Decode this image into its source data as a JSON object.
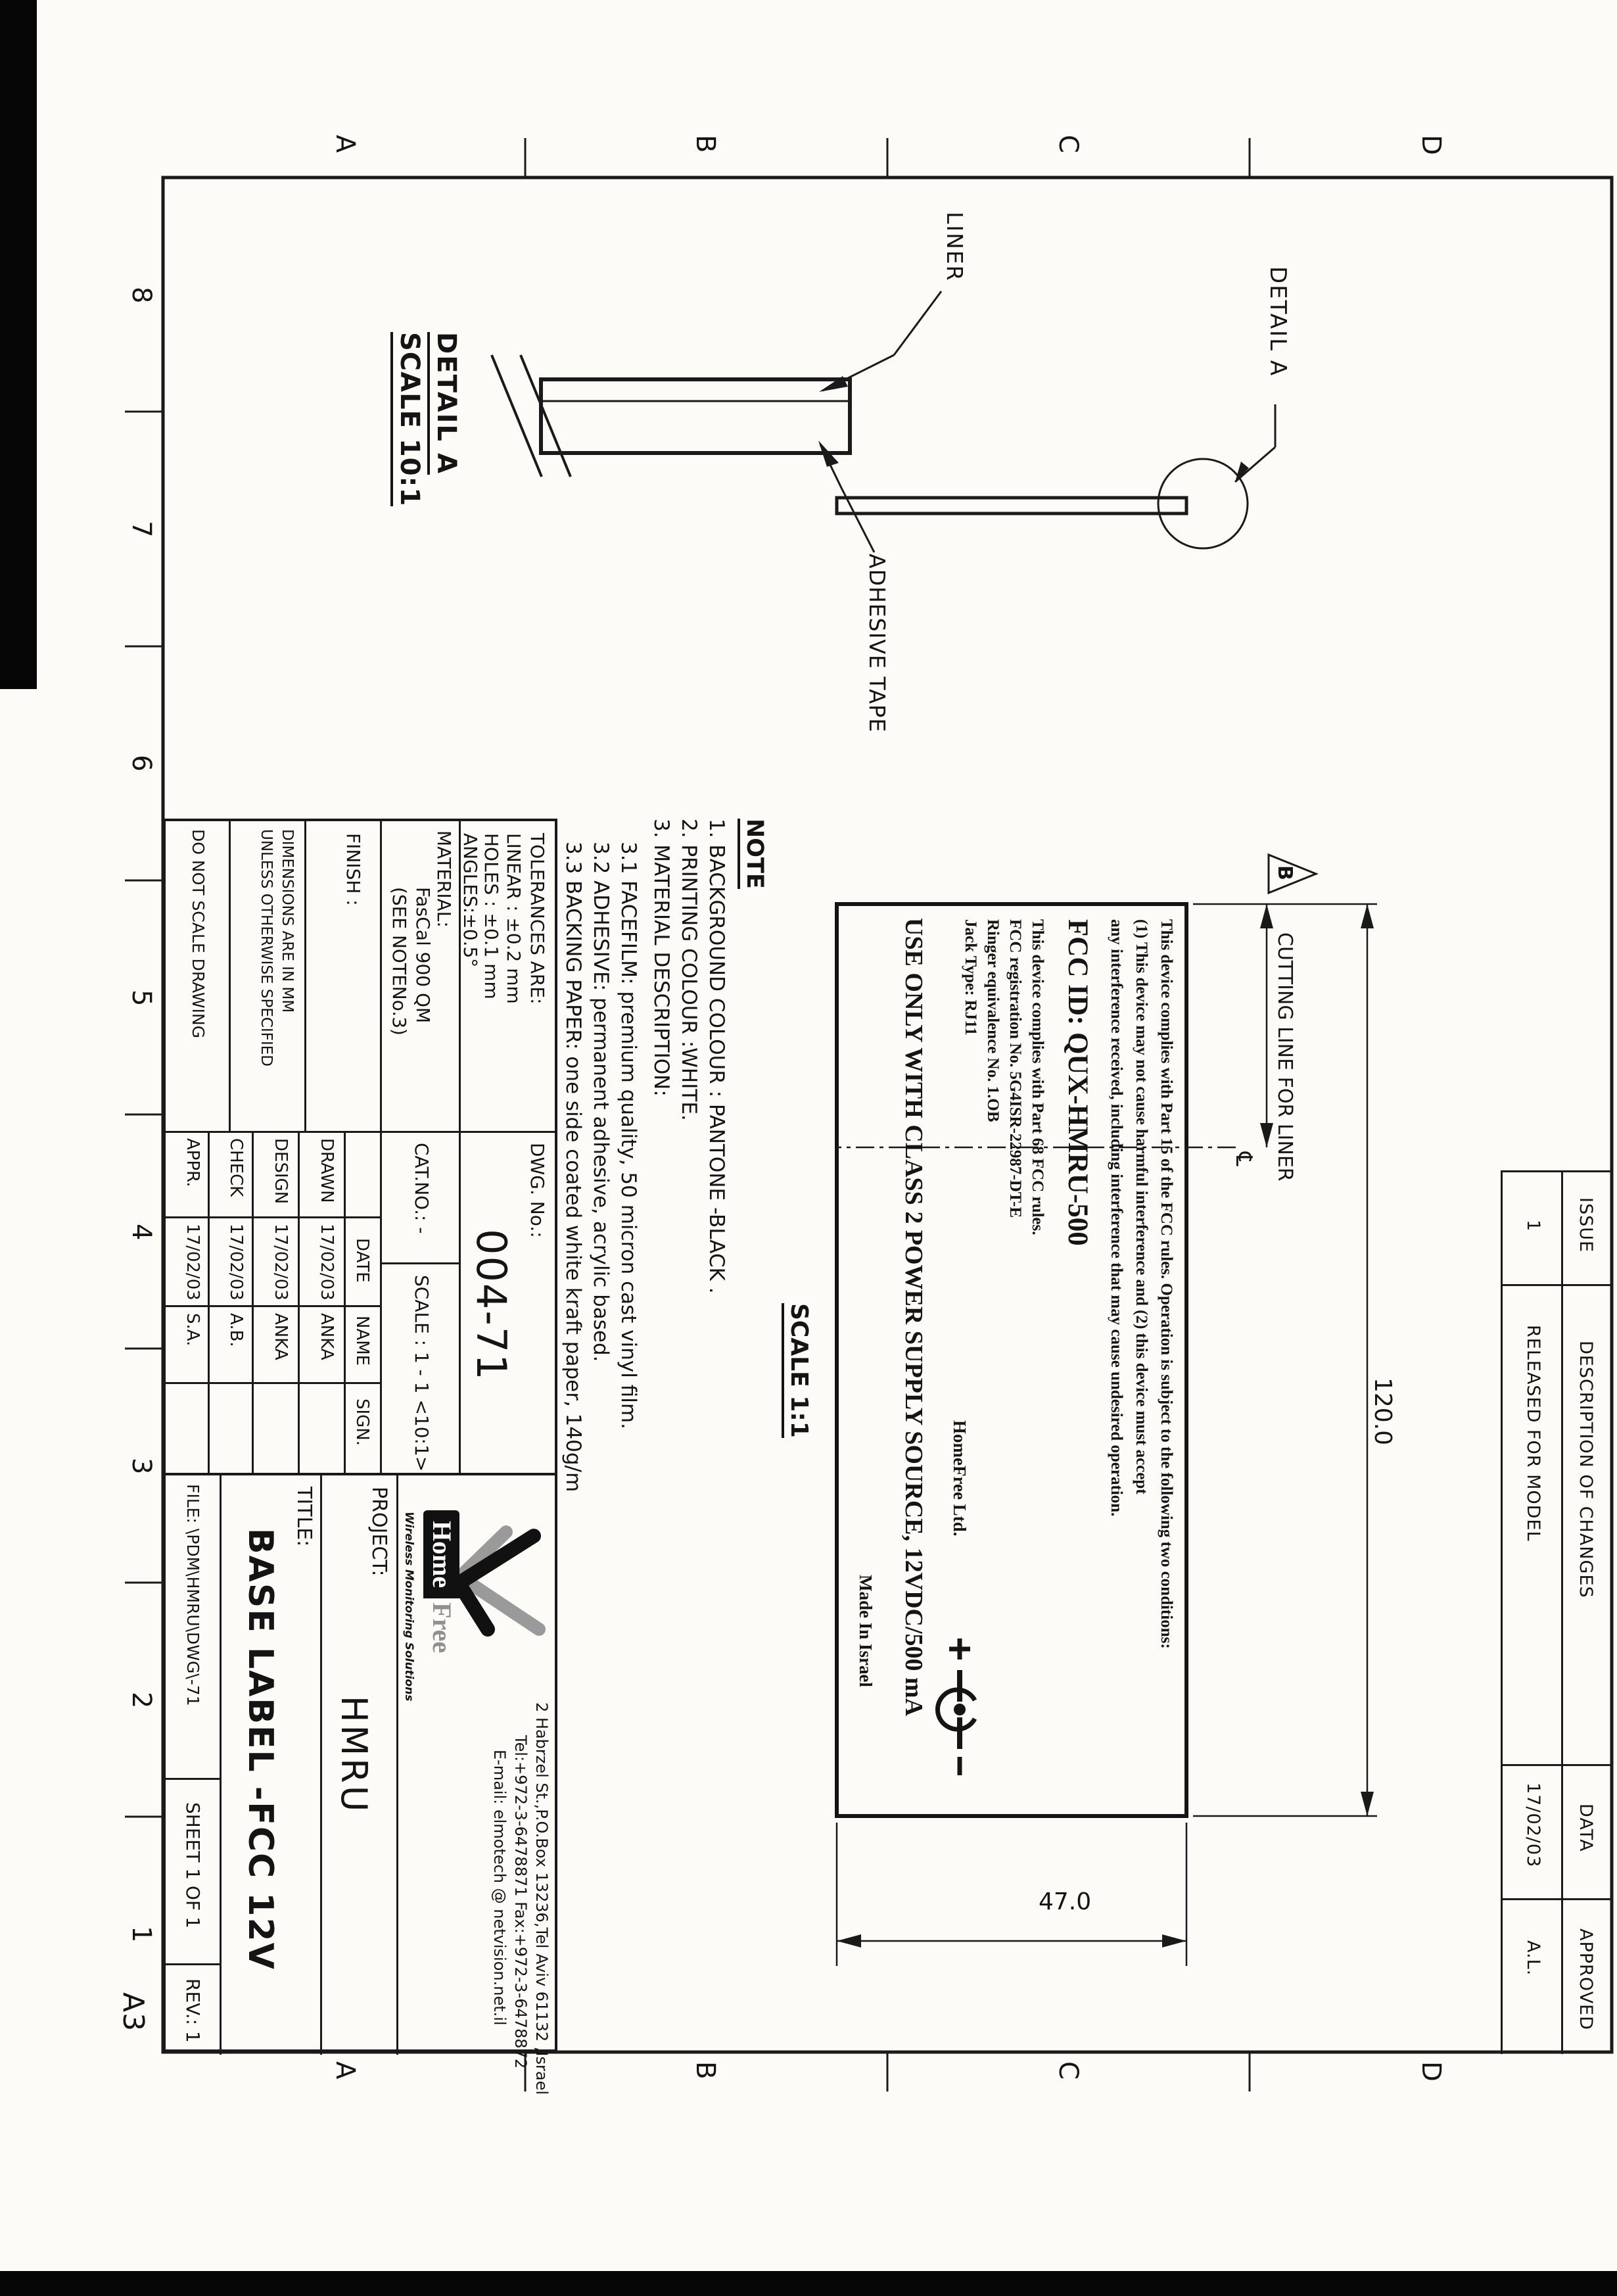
{
  "sheet": {
    "format": "A3",
    "zone_letters": [
      "D",
      "C",
      "B",
      "A"
    ],
    "zone_numbers": [
      "8",
      "7",
      "6",
      "5",
      "4",
      "3",
      "2",
      "1"
    ]
  },
  "revision_table": {
    "headers": {
      "issue": "ISSUE",
      "description": "DESCRIPTION OF CHANGES",
      "date": "DATA",
      "approved": "APPROVED"
    },
    "row": {
      "issue": "1",
      "description": "RELEASED FOR MODEL",
      "date": "17/02/03",
      "approved": "A.L."
    }
  },
  "views": {
    "detail_callout": "DETAIL A",
    "label_face": {
      "p15_lines": [
        "This device complies with Part 15 of the FCC rules. Operation is subject to the following two conditions:",
        "(1) This device may not cause harmful interference and (2) this device must accept",
        "any interference received, including interference that may cause undesired operation."
      ],
      "fcc_id": "FCC ID: QUX-HMRU-500",
      "p68_lines": [
        "This device complies with Part 68 FCC rules.",
        "FCC registration No. 5G4ISR-22987-DT-E",
        "Ringer equivalence No. 1.OB",
        "Jack Type: RJ11"
      ],
      "power_line": "USE ONLY WITH CLASS 2 POWER SUPPLY SOURCE, 12VDC/500 mA",
      "manufacturer": "HomeFree Ltd.",
      "made_in": "Made In Israel",
      "scale_note": "SCALE 1:1"
    },
    "dims": {
      "width": "120.0",
      "height": "47.0",
      "cutting_line": "CUTTING LINE FOR LINER",
      "flag": "B",
      "centerline": "℄"
    },
    "detail_view": {
      "title": "DETAIL A",
      "scale": "SCALE 10:1",
      "liner_label": "LINER",
      "tape_label": "ADHESIVE TAPE"
    }
  },
  "note": {
    "title": "NOTE",
    "lines": [
      "1. BACKGROUND COLOUR : PANTONE -BLACK .",
      "2. PRINTING COLOUR :WHITE.",
      "3. MATERIAL DESCRIPTION:",
      "3.1  FACEFILM:  premium quality, 50 micron cast vinyl film.",
      "3.2  ADHESIVE: permanent adhesive, acrylic based.",
      "3.3  BACKING PAPER: one side coated white kraft paper, 140g/m"
    ]
  },
  "title_block": {
    "tolerances": [
      "TOLERANCES  ARE:",
      "LINEAR : ±0.2 mm",
      "HOLES :  ±0.1 mm",
      "ANGLES:±0.5°"
    ],
    "dwg_label": "DWG. No.:",
    "dwg_value": "004-71",
    "material": [
      "MATERIAL:",
      "FasCal 900 QM",
      "(SEE NOTENo.3)"
    ],
    "cat_label": "CAT.NO.:  -",
    "scale_label": "SCALE : 1 - 1 <10:1>",
    "finish_label": "FINISH :",
    "dims_note": [
      "DIMENSIONS  ARE  IN  MM",
      "UNLESS  OTHERWISE  SPECIFIED"
    ],
    "do_not_scale": "DO  NOT  SCALE  DRAWING",
    "sig_table": {
      "headers": [
        "DATE",
        "NAME",
        "SIGN."
      ],
      "rows": [
        {
          "label": "DRAWN",
          "date": "17/02/03",
          "name": "ANKA"
        },
        {
          "label": "DESIGN",
          "date": "17/02/03",
          "name": "ANKA"
        },
        {
          "label": "CHECK",
          "date": "17/02/03",
          "name": "A.B."
        },
        {
          "label": "APPR.",
          "date": "17/02/03",
          "name": "S.A."
        }
      ]
    },
    "company": {
      "name_home": "Home",
      "name_free": "Free",
      "tagline": "Wireless Monitoring Solutions",
      "address_lines": [
        "2 Habrzel St.,P.O.Box 13236,Tel Aviv 61132 ,Israel",
        "Tel:+972-3-6478871 Fax:+972-3-6478872",
        "E-mail: elmotech @ netvision.net.il"
      ]
    },
    "project_label": "PROJECT:",
    "project_value": "HMRU",
    "title_label": "TITLE:",
    "title_value": "BASE LABEL -FCC 12V",
    "file_label": "FILE: \\PDM\\HMRU\\DWG\\-71",
    "sheet_label": "SHEET  1 OF 1",
    "rev_label": "REV.: 1"
  }
}
